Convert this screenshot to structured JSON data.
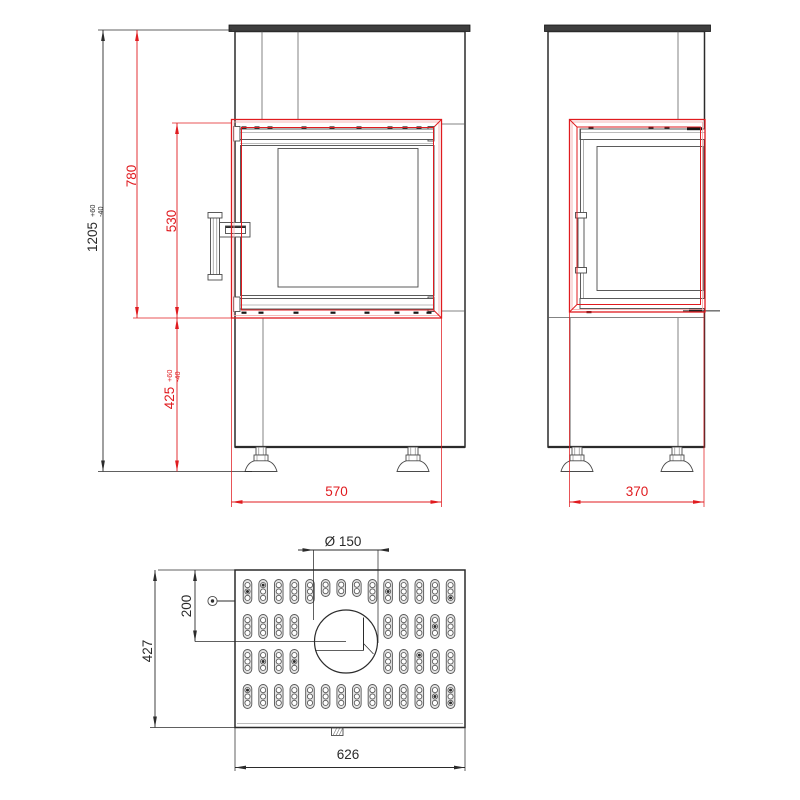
{
  "dims": {
    "total_height": {
      "value": "1205",
      "tol_plus": "+60",
      "tol_minus": "-40"
    },
    "firebox_height": "780",
    "door_height": "530",
    "base_height": {
      "value": "425",
      "tol_plus": "+60",
      "tol_minus": "-40"
    },
    "firebox_width": "570",
    "firebox_depth": "370",
    "flue_diameter": "Ø 150",
    "flue_offset": "200",
    "top_depth": "427",
    "top_width": "626"
  },
  "colors": {
    "dim_red": "#e01b1f",
    "highlight_pink": "#f3a6a6",
    "line_black": "#2b2b2b"
  },
  "top_view": {
    "vent_grid": {
      "col_start": 247.5,
      "col_pitch": 15.62,
      "slot_w": 8.6,
      "slot_h": 24,
      "slot_short_h": 17,
      "hole_r": 2.6,
      "holes": [
        5.6,
        12,
        18.4
      ],
      "holes_short": [
        5.2,
        11.6
      ],
      "rows": [
        {
          "y": 579.5,
          "cols": [
            1,
            2,
            3,
            4,
            5,
            6,
            7,
            8,
            9,
            10,
            11,
            12,
            13,
            14
          ],
          "short_cols": [
            6,
            7,
            8
          ]
        },
        {
          "y": 614.5,
          "cols": [
            1,
            2,
            3,
            4,
            10,
            11,
            12,
            13,
            14
          ],
          "short_cols": []
        },
        {
          "y": 649.5,
          "cols": [
            1,
            2,
            3,
            4,
            10,
            11,
            12,
            13,
            14
          ],
          "short_cols": []
        },
        {
          "y": 684.5,
          "cols": [
            1,
            2,
            3,
            4,
            5,
            6,
            7,
            8,
            9,
            10,
            11,
            12,
            13,
            14
          ],
          "short_cols": []
        }
      ],
      "dark_dots": [
        [
          1,
          1,
          2
        ],
        [
          1,
          2,
          1
        ],
        [
          1,
          10,
          2
        ],
        [
          1,
          14,
          3
        ],
        [
          2,
          13,
          2
        ],
        [
          3,
          2,
          2
        ],
        [
          3,
          4,
          2
        ],
        [
          3,
          12,
          1
        ],
        [
          4,
          1,
          1
        ],
        [
          4,
          13,
          2
        ],
        [
          4,
          14,
          1
        ],
        [
          4,
          14,
          3
        ]
      ]
    }
  }
}
